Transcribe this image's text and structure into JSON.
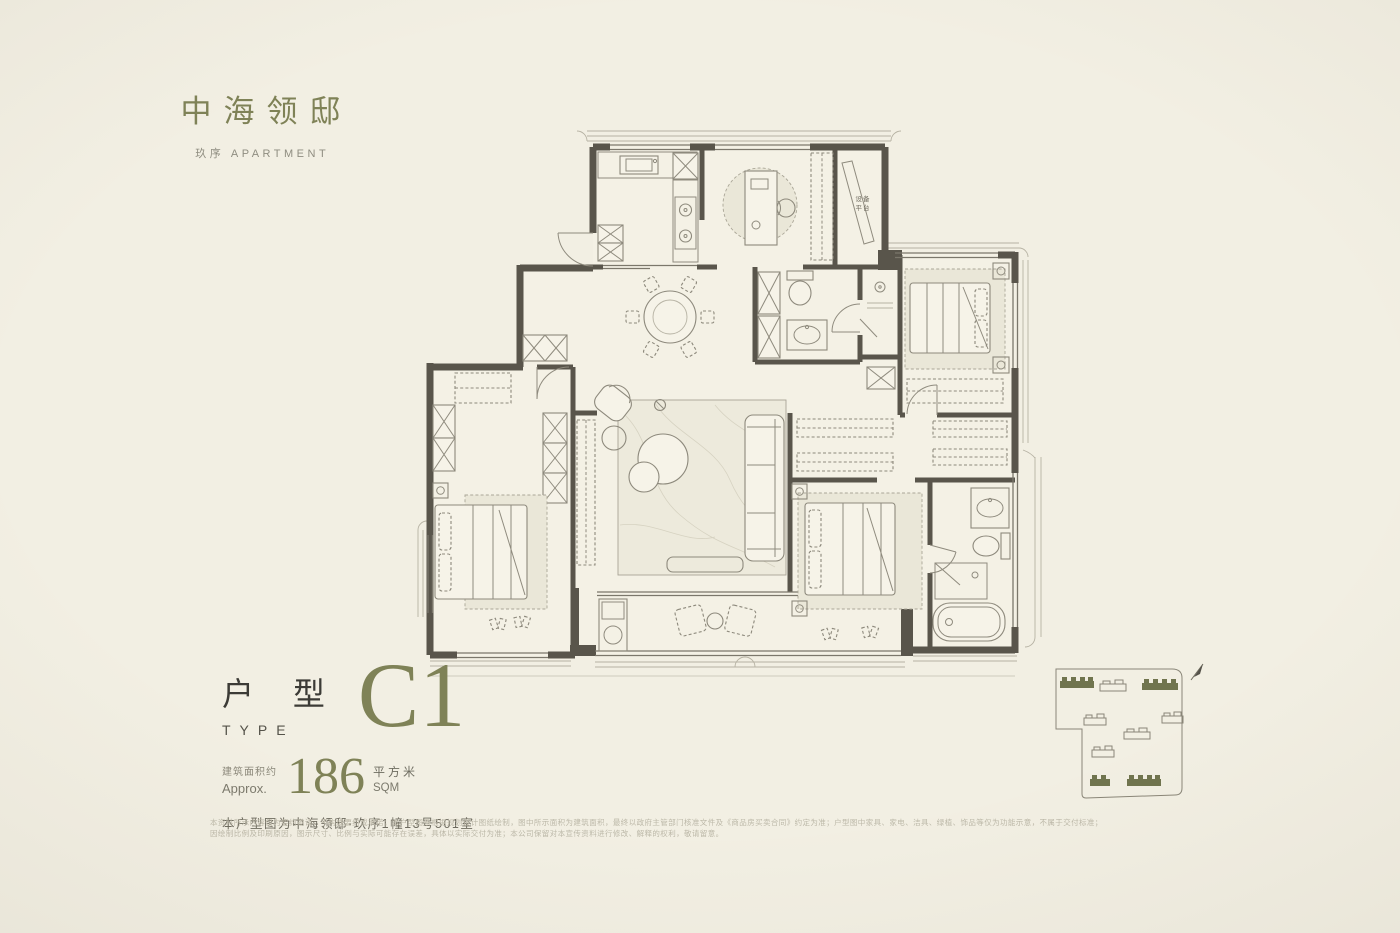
{
  "brand": {
    "name": "中海领邸",
    "subtitle": "玖序 APARTMENT"
  },
  "unit": {
    "type_cn": "户 型",
    "type_en": "TYPE",
    "type_code": "C1",
    "area_label_cn": "建筑面积约",
    "area_label_en": "Approx.",
    "area_value": "186",
    "area_unit_cn": "平方米",
    "area_unit_en": "SQM",
    "location_note": "本户型图为中海领邸·玖序1幢13号501室"
  },
  "floorplan": {
    "equipment_platform_line1": "设备",
    "equipment_platform_line2": "平台"
  },
  "disclaimer": {
    "line1": "本资料所示内容仅为要约邀请，不构成要约或承诺；本户型图系根据规划设计图纸绘制，图中所示面积为建筑面积，最终以政府主管部门核准文件及《商品房买卖合同》约定为准；户型图中家具、家电、洁具、绿植、饰品等仅为功能示意，不属于交付标准；",
    "line2": "因绘制比例及印刷原因，图示尺寸、比例与实际可能存在误差，具体以实际交付为准；本公司保留对本宣传资料进行修改、解释的权利，敬请留意。"
  },
  "colors": {
    "background": "#f2efe3",
    "wall": "#59554b",
    "accent_olive": "#7f8257",
    "ink": "#3d3c37"
  }
}
